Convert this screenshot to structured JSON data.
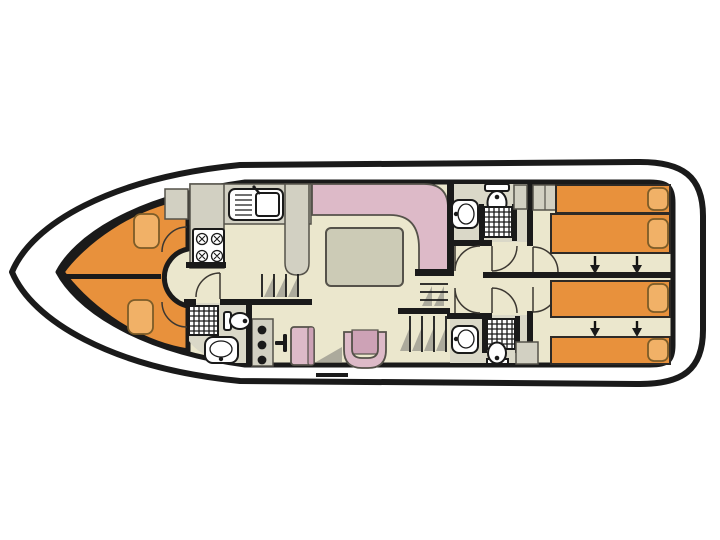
{
  "page": {
    "background": "#ffffff",
    "content": "houseboat-floor-plan"
  },
  "colors": {
    "page_bg": "#ffffff",
    "deck_white": "#ffffff",
    "hull_outline": "#1a1a1a",
    "wall_black": "#1a1a1a",
    "floor_beige": "#ebe7cd",
    "wetroom_gray": "#dad8c8",
    "cabinet_gray": "#d2d0c2",
    "bed_orange": "#e8913c",
    "pillow_orange": "#f1b167",
    "pillow_edge": "#7c5c28",
    "sofa_pink": "#ddbac8",
    "seat_pink_dark": "#cda2b6",
    "table_gray": "#cccbb6",
    "fixture_white": "#ffffff",
    "shadow_gray": "#acaa9c",
    "outline_thin": "#55524a"
  },
  "plan": {
    "type": "boat-deck-plan",
    "orientation": "bow-left-stern-right",
    "areas": [
      {
        "name": "bow-cabin",
        "features": [
          "upper-berth",
          "lower-berth",
          "2-pillows",
          "corner-cabinet",
          "round-vestibule",
          "2-berth-doors"
        ]
      },
      {
        "name": "kitchen",
        "features": [
          "l-shaped-counter",
          "sink-with-drainer",
          "4-burner-stove",
          "breakfast-bar"
        ]
      },
      {
        "name": "saloon",
        "features": [
          "l-shaped-sofa",
          "dining-table",
          "u-armchair"
        ]
      },
      {
        "name": "helm-station",
        "features": [
          "instrument-console-3-dials",
          "throttle-lever",
          "helm-seat",
          "3-side-steps"
        ]
      },
      {
        "name": "front-bathroom",
        "features": [
          "shower",
          "toilet",
          "washbasin"
        ]
      },
      {
        "name": "mid-bathroom-top",
        "features": [
          "toilet",
          "shower",
          "washbasin",
          "cabinet"
        ]
      },
      {
        "name": "mid-bathroom-bottom",
        "features": [
          "shower",
          "toilet",
          "washbasin"
        ]
      },
      {
        "name": "aft-cabin-top",
        "features": [
          "2-single-beds",
          "2-pillows",
          "slide-arrow-pair",
          "wardrobe"
        ]
      },
      {
        "name": "aft-cabin-bottom",
        "features": [
          "2-single-beds",
          "2-pillows",
          "slide-arrow-pair",
          "corner-cabinet"
        ]
      },
      {
        "name": "stairs",
        "features": [
          "upper-flight-3-treads",
          "lower-flight-4-treads"
        ]
      },
      {
        "name": "stern-deck-mark",
        "features": [
          "boarding-dash"
        ]
      }
    ],
    "counts": {
      "aft_single_beds": 4,
      "bow_berths": 2,
      "bathrooms": 3,
      "showers": 3,
      "toilets": 3,
      "washbasins": 3,
      "stove_burners": 4,
      "slide_arrows": 4
    }
  }
}
